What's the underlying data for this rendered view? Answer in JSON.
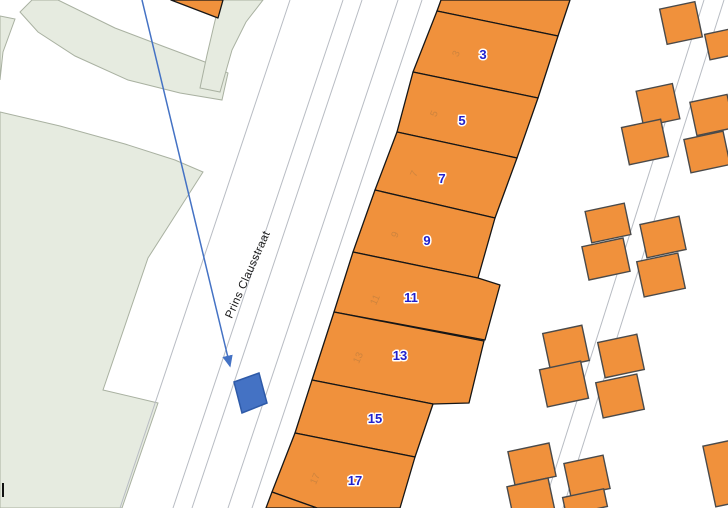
{
  "map": {
    "width": 728,
    "height": 508,
    "colors": {
      "background": "#ffffff",
      "park_fill": "#E6EBE0",
      "park_stroke": "#A9B1A1",
      "road_line": "#B8BCC3",
      "parcel_fill": "#F0913C",
      "parcel_stroke": "#161616",
      "building_fill": "#F0913C",
      "building_stroke": "#4A4A4A",
      "house_number": "#2121CC",
      "house_number_halo": "#FFFFFF",
      "faint_number": "#C9823E",
      "highlight_fill": "#4472C4",
      "highlight_stroke": "#2E5AA8",
      "arrow": "#4472C4",
      "street_text": "#1A1A1A",
      "tick": "#111111"
    },
    "street_label": {
      "text": "Prins Clausstraat",
      "x": 251,
      "y": 276,
      "angle": -66,
      "size": 11.5
    },
    "green_areas": [
      {
        "name": "park-main",
        "points": [
          [
            0,
            112
          ],
          [
            60,
            126
          ],
          [
            125,
            144
          ],
          [
            175,
            160
          ],
          [
            203,
            172
          ],
          [
            148,
            258
          ],
          [
            103,
            390
          ],
          [
            158,
            403
          ],
          [
            122,
            508
          ],
          [
            0,
            508
          ]
        ]
      },
      {
        "name": "park-wedge",
        "points": [
          [
            0,
            16
          ],
          [
            15,
            19
          ],
          [
            3,
            52
          ],
          [
            0,
            80
          ]
        ]
      },
      {
        "name": "park-band",
        "points": [
          [
            32,
            0
          ],
          [
            58,
            0
          ],
          [
            115,
            28
          ],
          [
            165,
            47
          ],
          [
            205,
            62
          ],
          [
            228,
            73
          ],
          [
            222,
            100
          ],
          [
            180,
            93
          ],
          [
            128,
            80
          ],
          [
            75,
            56
          ],
          [
            38,
            32
          ],
          [
            20,
            12
          ]
        ]
      },
      {
        "name": "park-strip",
        "points": [
          [
            220,
            0
          ],
          [
            263,
            0
          ],
          [
            246,
            22
          ],
          [
            232,
            50
          ],
          [
            220,
            92
          ],
          [
            200,
            88
          ],
          [
            207,
            55
          ],
          [
            214,
            25
          ]
        ]
      }
    ],
    "street_lines": [
      {
        "x1": 290,
        "y1": 0,
        "x2": 120,
        "y2": 508
      },
      {
        "x1": 343,
        "y1": 0,
        "x2": 173,
        "y2": 508
      },
      {
        "x1": 362,
        "y1": 0,
        "x2": 192,
        "y2": 508
      },
      {
        "x1": 398,
        "y1": 0,
        "x2": 228,
        "y2": 508
      },
      {
        "x1": 422,
        "y1": 0,
        "x2": 252,
        "y2": 508
      },
      {
        "x1": 704,
        "y1": 0,
        "x2": 543,
        "y2": 508
      },
      {
        "x1": 724,
        "y1": 0,
        "x2": 563,
        "y2": 508
      }
    ],
    "parcels": [
      {
        "id": "1",
        "points": [
          [
            441,
            0
          ],
          [
            570,
            0
          ],
          [
            558,
            36
          ],
          [
            437,
            11
          ]
        ],
        "label": null,
        "faint": null
      },
      {
        "id": "3",
        "points": [
          [
            437,
            11
          ],
          [
            558,
            36
          ],
          [
            538,
            98
          ],
          [
            413,
            72
          ]
        ],
        "label": {
          "text": "3",
          "x": 483,
          "y": 59
        },
        "faint": {
          "text": "3",
          "x": 459,
          "y": 55
        }
      },
      {
        "id": "5",
        "points": [
          [
            413,
            72
          ],
          [
            538,
            98
          ],
          [
            517,
            158
          ],
          [
            397,
            132
          ]
        ],
        "label": {
          "text": "5",
          "x": 462,
          "y": 125
        },
        "faint": {
          "text": "5",
          "x": 437,
          "y": 115
        }
      },
      {
        "id": "7",
        "points": [
          [
            397,
            132
          ],
          [
            517,
            158
          ],
          [
            495,
            218
          ],
          [
            375,
            190
          ]
        ],
        "label": {
          "text": "7",
          "x": 442,
          "y": 183
        },
        "faint": {
          "text": "7",
          "x": 417,
          "y": 175
        }
      },
      {
        "id": "9",
        "points": [
          [
            375,
            190
          ],
          [
            495,
            218
          ],
          [
            478,
            278
          ],
          [
            353,
            252
          ]
        ],
        "label": {
          "text": "9",
          "x": 427,
          "y": 245
        },
        "faint": {
          "text": "9",
          "x": 398,
          "y": 236
        }
      },
      {
        "id": "11",
        "points": [
          [
            353,
            252
          ],
          [
            478,
            278
          ],
          [
            500,
            285
          ],
          [
            485,
            340
          ],
          [
            334,
            312
          ]
        ],
        "label": {
          "text": "11",
          "x": 411,
          "y": 302
        },
        "faint": {
          "text": "11",
          "x": 378,
          "y": 301
        }
      },
      {
        "id": "13",
        "points": [
          [
            334,
            312
          ],
          [
            484,
            341
          ],
          [
            469,
            403
          ],
          [
            433,
            404
          ],
          [
            312,
            380
          ]
        ],
        "label": {
          "text": "13",
          "x": 400,
          "y": 360
        },
        "faint": {
          "text": "13",
          "x": 361,
          "y": 359
        }
      },
      {
        "id": "15",
        "points": [
          [
            312,
            380
          ],
          [
            433,
            404
          ],
          [
            415,
            457
          ],
          [
            295,
            433
          ]
        ],
        "label": {
          "text": "15",
          "x": 375,
          "y": 423
        },
        "faint": null
      },
      {
        "id": "17",
        "points": [
          [
            295,
            433
          ],
          [
            415,
            457
          ],
          [
            400,
            508
          ],
          [
            317,
            508
          ],
          [
            272,
            492
          ]
        ],
        "label": {
          "text": "17",
          "x": 355,
          "y": 485
        },
        "faint": {
          "text": "17",
          "x": 318,
          "y": 480
        }
      },
      {
        "id": "19",
        "points": [
          [
            272,
            492
          ],
          [
            317,
            508
          ],
          [
            266,
            508
          ]
        ],
        "label": null,
        "faint": null
      },
      {
        "id": "corner-building",
        "points": [
          [
            171,
            0
          ],
          [
            223,
            0
          ],
          [
            218,
            18
          ]
        ],
        "label": null,
        "faint": null
      }
    ],
    "building_angle": -12,
    "faint_label_angle": -66,
    "small_buildings": [
      {
        "cx": 681,
        "cy": 23,
        "w": 36,
        "h": 36
      },
      {
        "cx": 722,
        "cy": 44,
        "w": 30,
        "h": 26
      },
      {
        "cx": 658,
        "cy": 105,
        "w": 37,
        "h": 36
      },
      {
        "cx": 645,
        "cy": 142,
        "w": 40,
        "h": 38
      },
      {
        "cx": 712,
        "cy": 115,
        "w": 38,
        "h": 34
      },
      {
        "cx": 707,
        "cy": 152,
        "w": 40,
        "h": 34
      },
      {
        "cx": 608,
        "cy": 223,
        "w": 40,
        "h": 32
      },
      {
        "cx": 606,
        "cy": 259,
        "w": 42,
        "h": 34
      },
      {
        "cx": 663,
        "cy": 237,
        "w": 40,
        "h": 34
      },
      {
        "cx": 661,
        "cy": 275,
        "w": 42,
        "h": 36
      },
      {
        "cx": 566,
        "cy": 347,
        "w": 40,
        "h": 36
      },
      {
        "cx": 564,
        "cy": 384,
        "w": 42,
        "h": 38
      },
      {
        "cx": 621,
        "cy": 356,
        "w": 40,
        "h": 36
      },
      {
        "cx": 620,
        "cy": 396,
        "w": 42,
        "h": 36
      },
      {
        "cx": 532,
        "cy": 464,
        "w": 42,
        "h": 34
      },
      {
        "cx": 531,
        "cy": 499,
        "w": 42,
        "h": 34
      },
      {
        "cx": 587,
        "cy": 476,
        "w": 40,
        "h": 34
      },
      {
        "cx": 585,
        "cy": 502,
        "w": 42,
        "h": 18
      },
      {
        "cx": 726,
        "cy": 473,
        "w": 34,
        "h": 62
      }
    ],
    "highlight_parcel": {
      "points": [
        [
          234,
          382
        ],
        [
          259,
          373
        ],
        [
          267,
          403
        ],
        [
          242,
          413
        ]
      ]
    },
    "arrow": {
      "x1": 142,
      "y1": 0,
      "x2": 230,
      "y2": 366
    },
    "corner_tick": {
      "x1": 3,
      "y1": 483,
      "x2": 3,
      "y2": 497
    }
  }
}
